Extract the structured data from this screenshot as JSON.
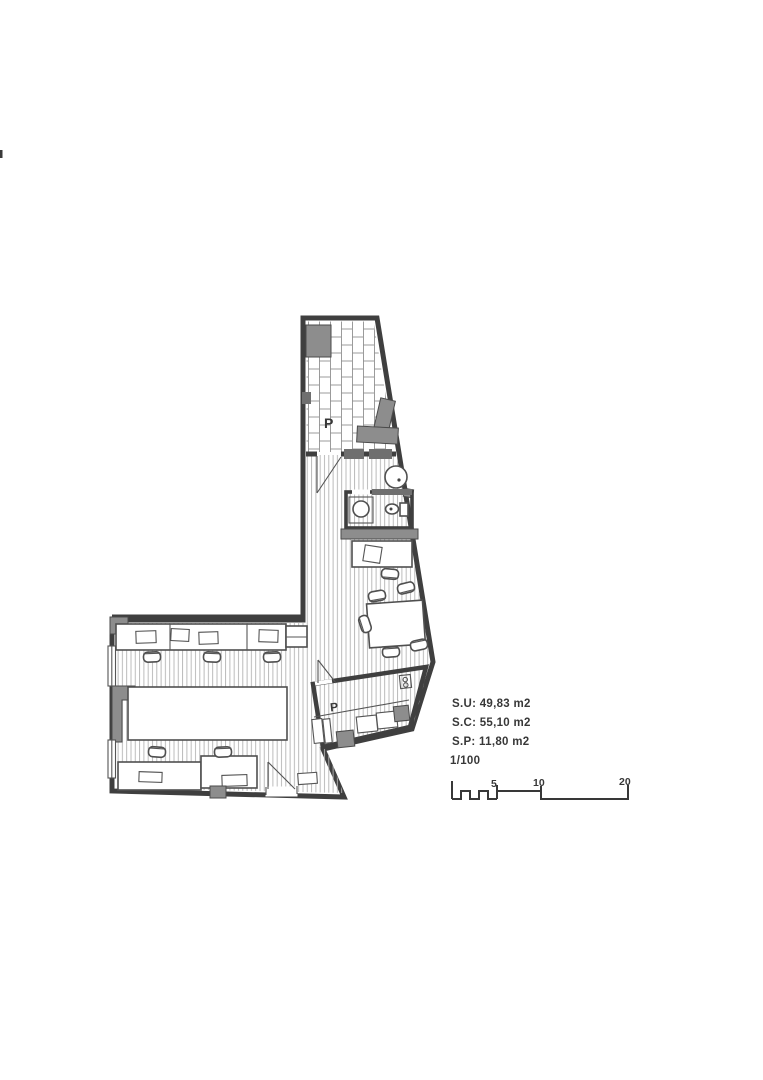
{
  "floor_plan": {
    "room_labels": {
      "terrace": "P",
      "patio": "P"
    },
    "annotations": {
      "su": "S.U: 49,83 m2",
      "sc": "S.C: 55,10 m2",
      "sp": "S.P: 11,80 m2",
      "scale": "1/100"
    },
    "scale_bar": {
      "tick_labels": [
        "5",
        "10",
        "20"
      ]
    },
    "colors": {
      "wall": "#3f3f3f",
      "ink": "#383838",
      "fill_gray": "#8d8d8d",
      "fill_dark": "#6f6f6f",
      "hatch": "#b4b4b4",
      "brick": "#909090",
      "paper": "#ffffff"
    }
  }
}
